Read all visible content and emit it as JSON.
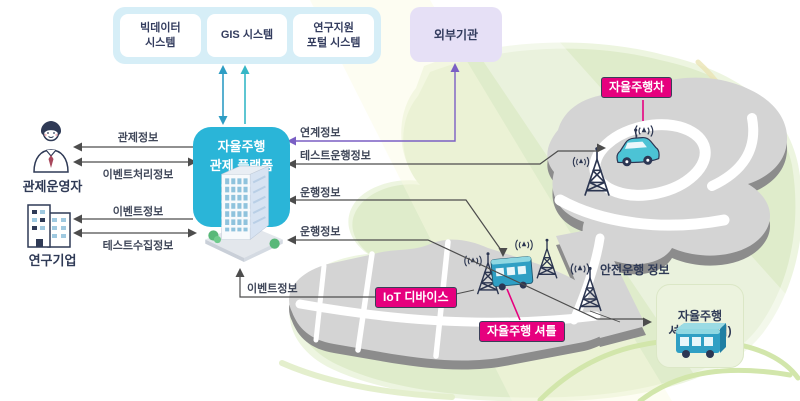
{
  "diagram": {
    "systems_panel": {
      "items": [
        {
          "id": "bigdata-system",
          "label": "빅데이터\n시스템"
        },
        {
          "id": "gis-system",
          "label": "GIS 시스템"
        },
        {
          "id": "research-portal-system",
          "label": "연구지원\n포털 시스템"
        }
      ]
    },
    "external_org": {
      "label": "외부기관"
    },
    "platform": {
      "label": "자율주행\n관제 플랫폼"
    },
    "actors": [
      {
        "id": "control-operator",
        "label": "관제운영자"
      },
      {
        "id": "research-company",
        "label": "연구기업"
      }
    ],
    "flows": {
      "left": [
        {
          "id": "control-info",
          "label": "관제정보"
        },
        {
          "id": "event-handling-info",
          "label": "이벤트처리정보"
        },
        {
          "id": "event-info",
          "label": "이벤트정보"
        },
        {
          "id": "test-collection-info",
          "label": "테스트수집정보"
        }
      ],
      "right": [
        {
          "id": "linkage-info",
          "label": "연계정보"
        },
        {
          "id": "test-operation-info",
          "label": "테스트운행정보"
        },
        {
          "id": "operation-info-1",
          "label": "운행정보"
        },
        {
          "id": "operation-info-2",
          "label": "운행정보"
        },
        {
          "id": "event-info-bottom",
          "label": "이벤트정보"
        },
        {
          "id": "safe-operation-info",
          "label": "안전운행 정보"
        }
      ]
    },
    "map_badges": [
      {
        "id": "autonomous-car",
        "label": "자율주행차"
      },
      {
        "id": "iot-device",
        "label": "IoT 디바이스"
      },
      {
        "id": "autonomous-shuttle",
        "label": "자율주행 셔틀"
      }
    ],
    "station_box": {
      "label": "자율주행\n셔틀(판교역)"
    }
  },
  "colors": {
    "platform_box": "#2ab5d8",
    "systems_panel": "#d6eef7",
    "external_org": "#e6e0f6",
    "badge_magenta": "#e6007e",
    "purple_arrow": "#7a5fc4",
    "teal_arrow_dark": "#2e9dc4",
    "teal_arrow_light": "#36b7c6",
    "gray_arrow": "#4d4d4d",
    "map_green": "#dfeccb",
    "road_gray": "#d4d4d4",
    "road_edge_gray": "#8c8c8c",
    "navy_text": "#2f3a56",
    "station_box": "#ecf3de"
  }
}
